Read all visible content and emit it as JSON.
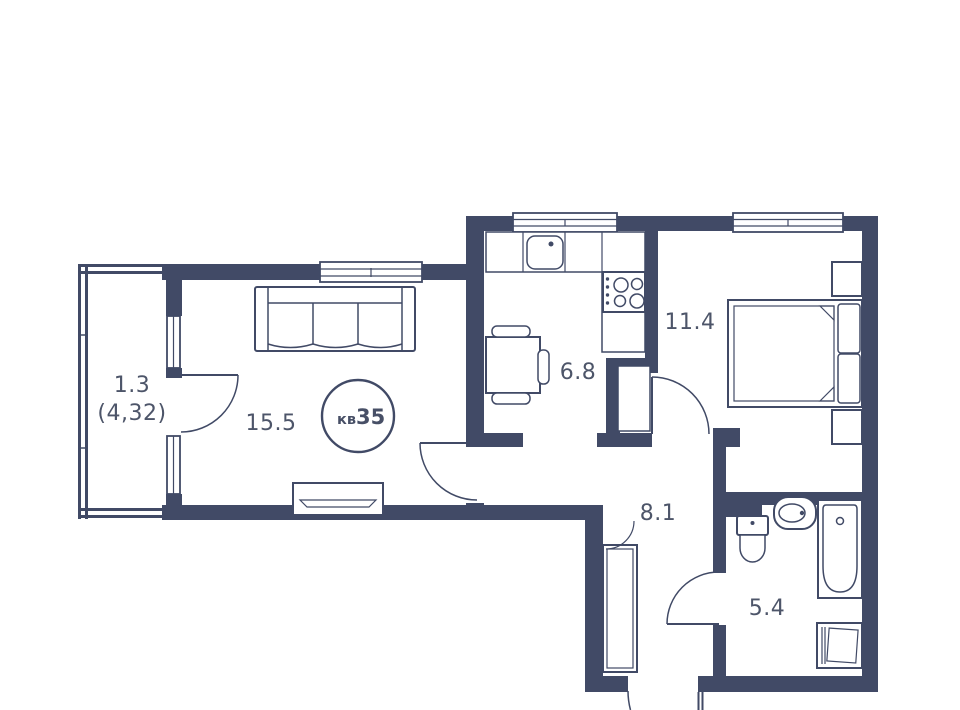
{
  "apartment": {
    "unit_label": "кв",
    "unit_number": "35"
  },
  "rooms": {
    "balcony": {
      "area": "1.3",
      "area_secondary": "(4,32)"
    },
    "living_room": {
      "area": "15.5"
    },
    "kitchen": {
      "area": "6.8"
    },
    "bedroom": {
      "area": "11.4"
    },
    "hallway": {
      "area": "8.1"
    },
    "bathroom": {
      "area": "5.4"
    }
  },
  "colors": {
    "walls": "#414a66",
    "background": "#ffffff",
    "labels": "#4d5569"
  },
  "icons": [
    "sofa-icon",
    "tv-stand-icon",
    "dining-table-icon",
    "dining-chair-icon",
    "kitchen-counter-icon",
    "kitchen-sink-icon",
    "stove-icon",
    "shaft-icon",
    "bed-icon",
    "pillow-icon",
    "nightstand-icon",
    "wardrobe-icon",
    "toilet-icon",
    "washbasin-icon",
    "bathtub-icon",
    "washing-machine-icon",
    "door-swing-icon",
    "window-icon"
  ]
}
